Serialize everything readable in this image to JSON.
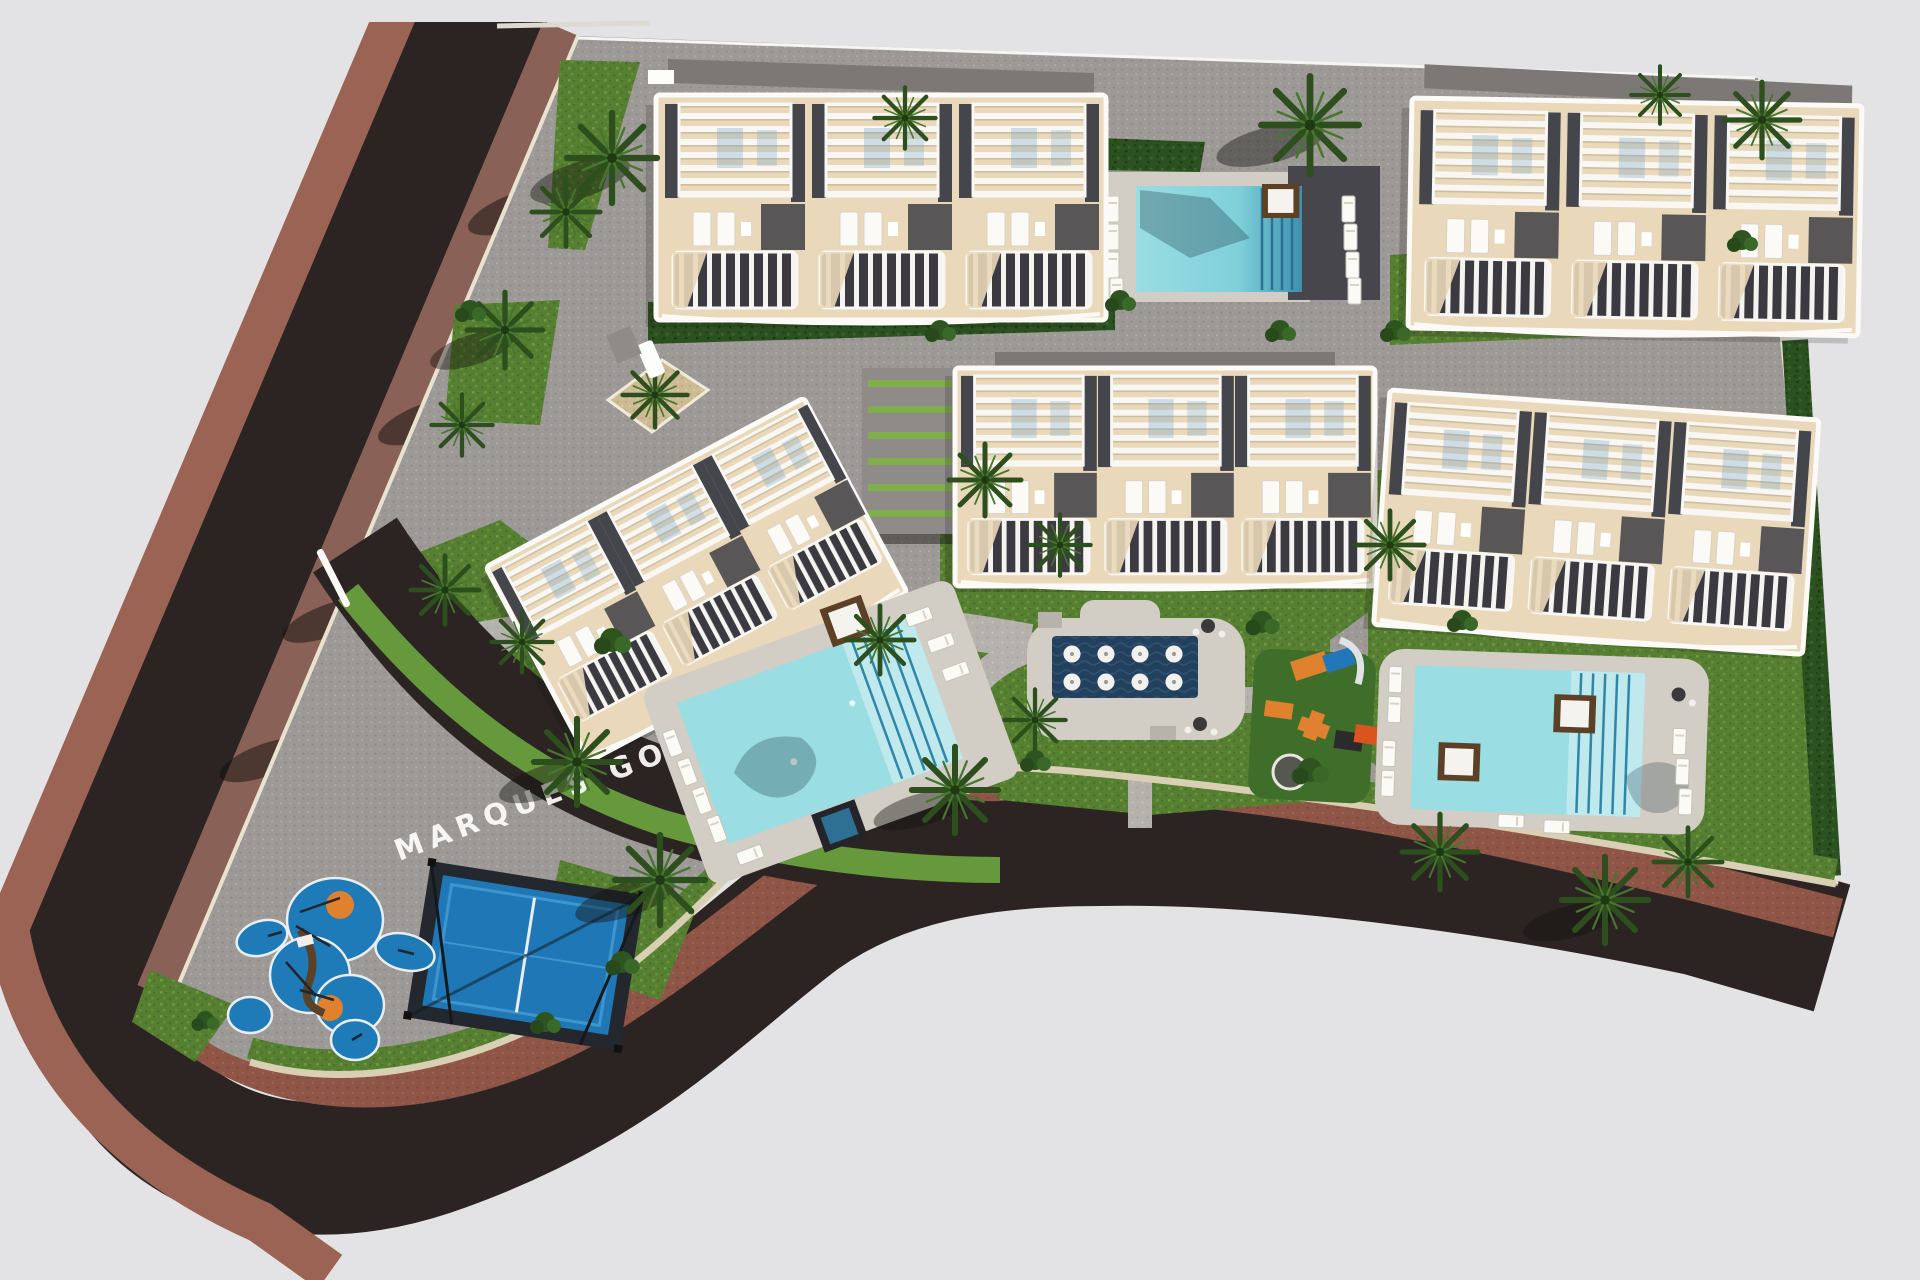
{
  "scene": {
    "entrance_label": "MARQUES GOLF",
    "site": {
      "residential_blocks": 5,
      "townhouse_units_per_block": 3,
      "swimming_pools": 3,
      "spa_wet_deck_umbrellas": 8,
      "padel_courts": 1,
      "playground_areas": 2
    },
    "palette": {
      "background": "#e3e3e5",
      "road": "#2b2422",
      "road_shadow": "#191512",
      "sidewalk_outer": "#9a6353",
      "sidewalk_inner": "#8a6157",
      "brick_path": "#8f5546",
      "pavers": "#9c9996",
      "walkway": "#b5b1ac",
      "curb": "#d8cfb5",
      "grass": "#567f31",
      "hedge": "#2c5120",
      "palm": "#2d4f1e",
      "roof_beige": "#e9d8b9",
      "roof_dark": "#45464c",
      "roof_gray": "#8b8987",
      "trim_white": "#f8f7f4",
      "pool_light": "#9adde2",
      "pool_deep": "#3e8fae",
      "pool_navy": "#23415e",
      "deck_light": "#d2cdc5",
      "deck_dark": "#46464c",
      "daybed_brown": "#5c4127",
      "court_blue": "#1f77b5",
      "play_blue": "#1f7ab8",
      "play_orange": "#e0812e",
      "rubber_green": "#3f6e2b"
    }
  }
}
